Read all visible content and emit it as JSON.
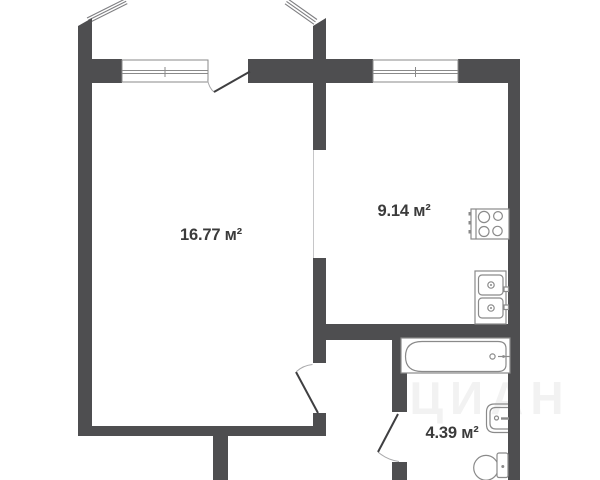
{
  "plan": {
    "type": "apartment-floor-plan",
    "colors": {
      "background": "#ffffff",
      "wall": "#4e4e50",
      "door": "#3f3f41",
      "fixture": "#8a8a8a",
      "glazing": "#7f7f82",
      "label": "#3b3b3b"
    },
    "rooms": [
      {
        "id": "living-room",
        "area_label": "16.77 м²"
      },
      {
        "id": "kitchen",
        "area_label": "9.14 м²"
      },
      {
        "id": "bathroom",
        "area_label": "4.39 м²"
      }
    ],
    "fixtures": [
      "stove-icon",
      "kitchen-sink-icon",
      "bathtub-icon",
      "washbasin-icon",
      "toilet-icon"
    ],
    "features": [
      "balcony-glazing",
      "window-living",
      "window-kitchen",
      "balcony-door",
      "living-room-door",
      "bathroom-door"
    ],
    "watermark": {
      "text": "ЦИАН",
      "digit": "2"
    }
  }
}
